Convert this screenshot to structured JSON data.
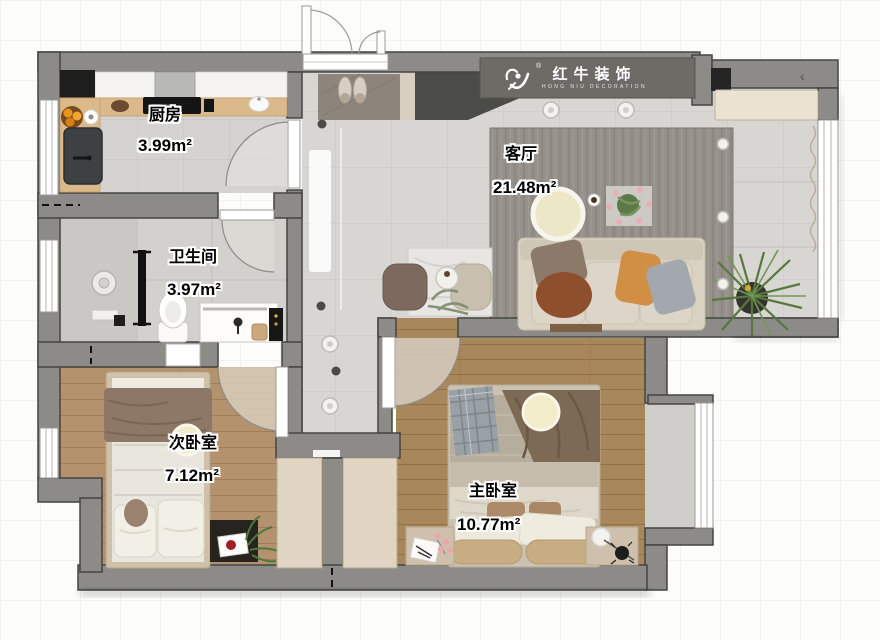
{
  "brand": {
    "name": "红牛装饰",
    "reg": "®",
    "subtitle": "HONG NIU DECORATION"
  },
  "rooms": [
    {
      "id": "kitchen",
      "name": "厨房",
      "area": "3.99m²"
    },
    {
      "id": "bathroom",
      "name": "卫生间",
      "area": "3.97m²"
    },
    {
      "id": "living",
      "name": "客厅",
      "area": "21.48m²"
    },
    {
      "id": "bedroom2",
      "name": "次卧室",
      "area": "7.12m²"
    },
    {
      "id": "master",
      "name": "主卧室",
      "area": "10.77m²"
    }
  ],
  "colors": {
    "wall": "#8d8b88",
    "wall_outline": "#454540",
    "logo_band": "#6d6b66",
    "cabinet_dark": "#4b4b48",
    "tile": "#d8d6d2",
    "wood_second_bedroom": "#b4926e",
    "wood_master_bedroom": "#a8875d",
    "rug": "#95908a",
    "sofa": "#d9d2c3",
    "pillow_orange": "#d18f45",
    "pillow_rust": "#8e4f2c",
    "plant_green": "#56783b",
    "ceiling_light": "#f2ecca"
  }
}
